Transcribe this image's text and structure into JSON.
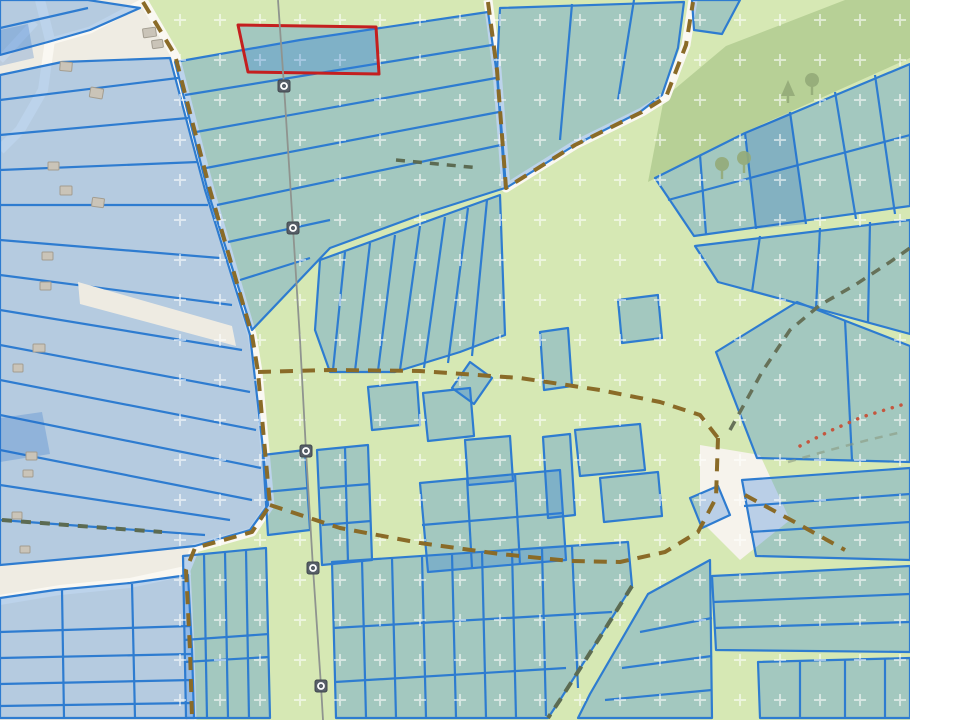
{
  "app": {
    "type": "cadastral-parcel-map",
    "description": "Web map with semi-transparent blue cadastral parcels over a topographic base, one parcel highlighted in red, dashed track paths, a power line with pylon markers, meadow/orchard and forest areas"
  },
  "palette": {
    "page_background": "#ffffff",
    "base_beige": "#efece3",
    "meadow_green": "#d6e8b4",
    "forest_olive": "#b7d096",
    "road_white": "#faf8f2",
    "parcel_fill": "rgba(45,125,220,0.30)",
    "parcel_fill_dark": "rgba(30,105,200,0.24)",
    "parcel_stroke": "#2e7cd0",
    "highlight_stroke": "#c41f1f",
    "track_brown": "#8a6b28",
    "track_dark": "#5c6b52",
    "trail_red": "#c4573f",
    "power_gray": "#8f948f",
    "pylon_fill": "#575f68",
    "building_fill": "#cac4b8",
    "building_stroke": "#a39d90",
    "tree_green": "#94ab79",
    "orchard_mark": "rgba(255,255,255,0.55)"
  },
  "map": {
    "viewbox": "0 0 910 720",
    "layers": [
      {
        "name": "base",
        "items": [
          {
            "t": "polygon",
            "points": "0,0 910,0 910,720 0,720",
            "fill": "#efece3"
          },
          {
            "t": "polygon",
            "points": "143,0 175,55 210,190 252,335 258,372 264,440 270,505 252,532 195,548 186,570 190,650 192,720 910,720 910,0",
            "fill": "#d6e8b4"
          }
        ]
      },
      {
        "name": "forest",
        "items": [
          {
            "t": "polygon",
            "points": "648,182 664,98 726,46 845,0 910,0 910,58 745,132",
            "fill": "#b7d096"
          }
        ]
      },
      {
        "name": "roads",
        "items": [
          {
            "t": "polyline",
            "points": "143,0 175,55 210,190 252,335 258,372 264,440 270,505 252,532 195,548 186,570 190,650 192,720",
            "stroke": "#faf8f2",
            "w": 9
          },
          {
            "t": "polyline",
            "points": "488,0 497,70 506,188 575,145 642,112 666,97 686,45 693,0",
            "stroke": "#faf8f2",
            "w": 9
          },
          {
            "t": "polyline",
            "points": "40,0 50,40 43,90 20,130 0,150",
            "stroke": "#faf8f2",
            "w": 10
          },
          {
            "t": "polyline",
            "points": "0,60 35,22",
            "stroke": "#faf8f2",
            "w": 8
          },
          {
            "t": "polyline",
            "points": "48,42 90,30 143,2",
            "stroke": "#faf8f2",
            "w": 7
          },
          {
            "t": "polyline",
            "points": "0,600 60,590 130,583 190,570",
            "stroke": "#faf8f2",
            "w": 10
          },
          {
            "t": "polygon",
            "points": "700,445 760,455 790,520 740,560 700,520",
            "fill": "#f6f3ec"
          }
        ]
      },
      {
        "name": "parcel-blocks",
        "items": [
          {
            "t": "block",
            "outline": "0,0 88,0 140,8 90,30 48,42 0,55",
            "dividers": [
              "0,28 88,8"
            ]
          },
          {
            "t": "block",
            "outline": "0,75 62,62 170,58 205,190 250,335 262,440 268,505 250,530 195,546 100,556 0,565",
            "dividers": [
              "0,100 178,78",
              "0,135 188,118",
              "0,170 198,162",
              "0,205 208,205",
              "0,240 220,258",
              "0,275 232,305",
              "0,310 242,350",
              "0,345 250,392",
              "0,380 256,430",
              "0,415 261,468",
              "0,450 252,500",
              "0,485 230,520",
              "0,520 205,535"
            ]
          },
          {
            "t": "polygon",
            "points": "78,282 232,326 236,346 80,304",
            "fill": "#eeebe2"
          },
          {
            "t": "block",
            "outline": "0,598 55,590 130,583 188,575 192,650 194,718 0,718",
            "dividers": [
              "0,632 191,626",
              "0,658 192,654",
              "0,684 193,680",
              "0,706 194,703",
              "62,590 64,718",
              "132,584 135,718"
            ]
          },
          {
            "t": "block",
            "outline": "175,62 300,40 488,12 497,75 505,188 420,215 330,248 252,330 208,192",
            "dividers": [
              "185,95 492,45",
              "196,132 496,78",
              "206,168 499,112",
              "217,205 501,145",
              "228,242 330,220",
              "240,280 310,258"
            ]
          },
          {
            "t": "block",
            "outline": "320,260 500,195 505,335 460,352 395,372 330,372 315,330",
            "dividers": [
              "345,252 333,370",
              "370,243 355,371",
              "395,235 378,371",
              "420,226 400,370",
              "445,217 424,368",
              "468,208 448,363",
              "487,200 472,356"
            ]
          },
          {
            "t": "block",
            "outline": "500,8 684,2 678,48 662,95 640,112 575,145 506,188 497,70",
            "dividers": [
              "572,4 560,140",
              "634,0 618,100"
            ]
          },
          {
            "t": "block",
            "outline": "655,178 745,133 910,64 910,206 694,236",
            "dividers": [
              "700,155 706,234",
              "745,133 756,229",
              "790,112 806,224",
              "835,92 856,219",
              "875,75 895,214",
              "668,200 910,135"
            ]
          },
          {
            "t": "polygon",
            "points": "745,133 790,112 806,224 756,229",
            "fill": "rgba(30,105,200,0.24)"
          },
          {
            "t": "block",
            "outline": "695,246 910,220 910,334 800,304 718,282",
            "dividers": [
              "760,236 752,292",
              "820,228 816,309",
              "870,222 868,322"
            ]
          },
          {
            "t": "block",
            "outline": "716,352 797,302 910,346 910,462 757,458",
            "dividers": [
              "845,320 852,460"
            ]
          },
          {
            "t": "block",
            "outline": "263,455 305,450 310,530 268,535",
            "dividers": [
              "265,492 308,488"
            ]
          },
          {
            "t": "block",
            "outline": "317,450 368,445 372,560 322,565",
            "dividers": [
              "320,488 370,484",
              "322,525 371,521",
              "345,447 348,563"
            ]
          },
          {
            "t": "polygon",
            "points": "368,387 417,382 420,425 372,430"
          },
          {
            "t": "polygon",
            "points": "423,393 470,388 474,436 428,441"
          },
          {
            "t": "polygon",
            "points": "470,362 492,378 474,404 452,388"
          },
          {
            "t": "polygon",
            "points": "465,440 510,436 513,481 468,485"
          },
          {
            "t": "block",
            "outline": "420,483 560,470 566,560 428,572",
            "dividers": [
              "467,478 472,568",
              "515,474 520,565",
              "422,525 563,513"
            ]
          },
          {
            "t": "polygon",
            "points": "543,437 570,434 575,515 548,518"
          },
          {
            "t": "polygon",
            "points": "575,430 640,424 645,470 580,476"
          },
          {
            "t": "polygon",
            "points": "600,478 658,472 662,516 604,522"
          },
          {
            "t": "polygon",
            "points": "540,332 568,328 572,386 544,390"
          },
          {
            "t": "polygon",
            "points": "618,300 658,295 662,338 622,343"
          },
          {
            "t": "polygon",
            "points": "692,0 740,0 722,34 694,30"
          },
          {
            "t": "polygon",
            "points": "690,498 718,486 730,515 702,528"
          },
          {
            "t": "block",
            "outline": "183,556 266,548 270,718 186,718",
            "dividers": [
              "204,554 207,718",
              "225,552 228,718",
              "246,550 249,718",
              "184,640 269,634",
              "184,662 269,657"
            ]
          },
          {
            "t": "block",
            "outline": "332,562 628,542 632,586 560,700 548,718 336,718",
            "dividers": [
              "362,560 366,718",
              "392,558 396,718",
              "422,556 426,718",
              "452,554 456,718",
              "482,552 486,718",
              "512,550 516,718",
              "542,548 546,716",
              "572,546 578,688",
              "333,628 612,612",
              "335,682 566,668"
            ]
          },
          {
            "t": "block",
            "outline": "648,594 710,560 712,718 578,718 590,694",
            "dividers": [
              "640,632 712,618",
              "622,668 712,656",
              "605,700 712,690"
            ]
          },
          {
            "t": "block",
            "outline": "742,480 910,468 910,560 756,556",
            "dividers": [
              "744,506 910,494",
              "750,532 910,522"
            ]
          },
          {
            "t": "block",
            "outline": "712,576 910,566 910,652 716,650",
            "dividers": [
              "713,602 910,594",
              "714,628 910,622"
            ]
          },
          {
            "t": "block",
            "outline": "758,662 910,658 910,718 760,718",
            "dividers": [
              "800,660 800,718",
              "845,659 845,718",
              "885,658 885,718"
            ]
          },
          {
            "t": "polygon",
            "points": "0,418 42,412 50,454 0,462",
            "fill": "rgba(30,105,200,0.24)"
          },
          {
            "t": "polygon",
            "points": "0,30 28,24 34,58 0,66",
            "fill": "rgba(30,105,200,0.24)"
          }
        ]
      },
      {
        "name": "orchard-pattern",
        "items": [
          {
            "t": "patternRect",
            "x": 150,
            "y": 0,
            "w": 760,
            "h": 720
          }
        ]
      },
      {
        "name": "highlighted-parcel",
        "items": [
          {
            "t": "polygon",
            "points": "238,25 376,27 379,74 248,72",
            "fill": "rgba(45,125,220,0.30)",
            "stroke": "#c41f1f",
            "w": 3
          }
        ]
      },
      {
        "name": "tracks",
        "items": [
          {
            "t": "polyline",
            "points": "143,2 175,55 210,190 252,335 258,372 264,440 270,505 252,532 195,548 186,570 190,650 192,718",
            "stroke": "#8a6b28",
            "w": 4,
            "dash": "13 9"
          },
          {
            "t": "polyline",
            "points": "488,2 497,70 506,188 575,145 642,112 666,97 686,45 693,2",
            "stroke": "#8a6b28",
            "w": 4,
            "dash": "13 9"
          },
          {
            "t": "polyline",
            "points": "258,372 330,370 420,371 520,378 600,390 660,402 700,415 718,438",
            "stroke": "#8a6b28",
            "w": 4,
            "dash": "13 9"
          },
          {
            "t": "polyline",
            "points": "270,505 340,528 420,543 500,554 570,561 620,562 665,552 698,532 716,498 718,438",
            "stroke": "#8a6b28",
            "w": 4,
            "dash": "13 9"
          },
          {
            "t": "polyline",
            "points": "745,495 800,525 845,550",
            "stroke": "#8a6b28",
            "w": 4,
            "dash": "13 9"
          },
          {
            "t": "polyline",
            "points": "730,430 762,372 790,330 820,305 855,285 890,262 910,248",
            "stroke": "#667158",
            "w": 3.5,
            "dash": "10 8"
          },
          {
            "t": "polyline",
            "points": "632,586 595,645 560,700 548,718",
            "stroke": "#5c6b52",
            "w": 4,
            "dash": "11 8"
          },
          {
            "t": "polyline",
            "points": "2,520 80,526 162,532",
            "stroke": "#5c6b52",
            "w": 4,
            "dash": "10 9"
          },
          {
            "t": "polyline",
            "points": "396,160 480,168",
            "stroke": "#5c6b52",
            "w": 3.5,
            "dash": "9 8"
          },
          {
            "t": "polyline",
            "points": "788,462 830,450 868,440 902,432",
            "stroke": "#8b9a80",
            "w": 2.5,
            "dash": "8 7",
            "opacity": 0.6
          },
          {
            "t": "polyline",
            "points": "800,446 832,430 862,417 888,409 908,403",
            "stroke": "#c4573f",
            "w": 3.5,
            "dash": "0.1 9",
            "cap": "round"
          }
        ]
      },
      {
        "name": "power-line",
        "items": [
          {
            "t": "polyline",
            "points": "278,0 284,86 293,228 300,340 306,451 313,568 321,686 323,720",
            "stroke": "#8f948f",
            "w": 1.8
          }
        ]
      },
      {
        "name": "pylon-markers",
        "items": [
          {
            "t": "pylon",
            "x": 284,
            "y": 86
          },
          {
            "t": "pylon",
            "x": 293,
            "y": 228
          },
          {
            "t": "pylon",
            "x": 306,
            "y": 451
          },
          {
            "t": "pylon",
            "x": 313,
            "y": 568
          },
          {
            "t": "pylon",
            "x": 321,
            "y": 686
          }
        ]
      },
      {
        "name": "trees",
        "items": [
          {
            "t": "tree",
            "x": 788,
            "y": 96,
            "kind": "conifer"
          },
          {
            "t": "tree",
            "x": 812,
            "y": 88,
            "kind": "deciduous"
          },
          {
            "t": "tree",
            "x": 722,
            "y": 172,
            "kind": "deciduous"
          },
          {
            "t": "tree",
            "x": 744,
            "y": 166,
            "kind": "deciduous"
          }
        ]
      },
      {
        "name": "buildings",
        "items": [
          {
            "t": "building",
            "x": 143,
            "y": 28,
            "w": 13,
            "h": 9,
            "r": -8
          },
          {
            "t": "building",
            "x": 152,
            "y": 40,
            "w": 11,
            "h": 8,
            "r": -8
          },
          {
            "t": "building",
            "x": 60,
            "y": 62,
            "w": 12,
            "h": 9,
            "r": 5
          },
          {
            "t": "building",
            "x": 90,
            "y": 88,
            "w": 13,
            "h": 10,
            "r": 10
          },
          {
            "t": "building",
            "x": 48,
            "y": 162,
            "w": 11,
            "h": 8,
            "r": 0
          },
          {
            "t": "building",
            "x": 60,
            "y": 186,
            "w": 12,
            "h": 9,
            "r": 0
          },
          {
            "t": "building",
            "x": 92,
            "y": 198,
            "w": 12,
            "h": 9,
            "r": 8
          },
          {
            "t": "building",
            "x": 42,
            "y": 252,
            "w": 11,
            "h": 8,
            "r": 0
          },
          {
            "t": "building",
            "x": 40,
            "y": 282,
            "w": 11,
            "h": 8,
            "r": 0
          },
          {
            "t": "building",
            "x": 33,
            "y": 344,
            "w": 12,
            "h": 8,
            "r": 0
          },
          {
            "t": "building",
            "x": 13,
            "y": 364,
            "w": 10,
            "h": 8,
            "r": 0
          },
          {
            "t": "building",
            "x": 26,
            "y": 452,
            "w": 11,
            "h": 8,
            "r": 0
          },
          {
            "t": "building",
            "x": 23,
            "y": 470,
            "w": 10,
            "h": 7,
            "r": 0
          },
          {
            "t": "building",
            "x": 12,
            "y": 512,
            "w": 10,
            "h": 7,
            "r": 0
          },
          {
            "t": "building",
            "x": 20,
            "y": 546,
            "w": 10,
            "h": 7,
            "r": 0
          }
        ]
      }
    ]
  }
}
